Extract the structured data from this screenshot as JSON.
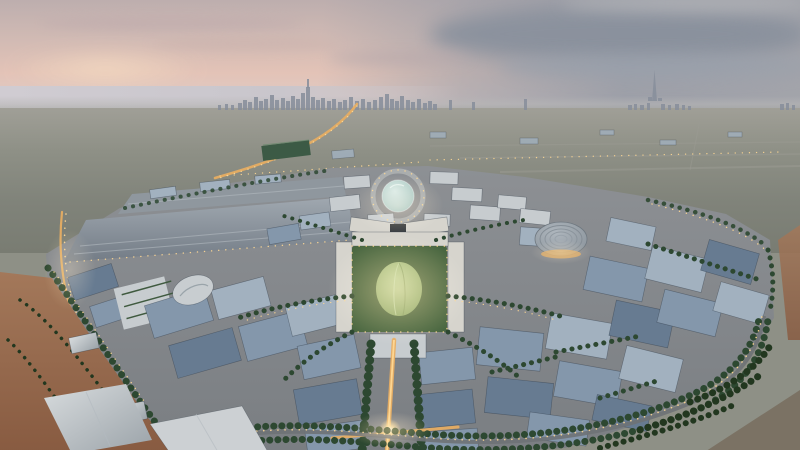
{
  "scene": {
    "description": "Aerial dusk rendering of a circular expo master-plan city (Expo 2020 Dubai style): illuminated boulevards, central garden dome, ribbed arena roof, long exhibition halls, palm-lined perimeter roads, desert sand, and the Dubai skyline with a tall spire tower on the horizon under a pink-and-grey sunset sky",
    "time_of_day": "dusk",
    "landmark_labels": {
      "skyline": "city skyline",
      "tall_tower": "tall spire tower",
      "glass_dome": "glass dome plaza",
      "green_dome": "garden dome pavilion",
      "arena": "ribbed round arena roof",
      "halls": "exhibition halls",
      "avenue": "illuminated avenue",
      "boulevard": "palm-lined boulevard",
      "desert": "desert sand"
    }
  },
  "colors": {
    "sky-top": "#bdaeae",
    "sky-warm": "#e3c3b7",
    "sky-glow": "#f2d8c0",
    "cloud-dark": "#8a919d",
    "cloud-mid": "#9aa1ac",
    "sea": "#c9c6cc",
    "skyline": "#878e9b",
    "plain-1": "#a09f97",
    "plain-2": "#8e9086",
    "plain-3": "#797c72",
    "site-1": "#8d9094",
    "site-2": "#7a7e82",
    "hall-1": "#a0a8b0",
    "hall-2": "#737c86",
    "roof-a": "#a2b1bf",
    "roof-b": "#8497ab",
    "roof-c": "#677b91",
    "roof-d": "#55697f",
    "white-1": "#c7cccf",
    "warm-white": "#d6d4cd",
    "trees": "#2d4831",
    "trees-dark": "#22371f",
    "garden": "#47653f",
    "dome-green-1": "#b7ca8c",
    "dome-green-2": "#87a263",
    "glass-1": "#d6e8e3",
    "glass-2": "#9cc0bb",
    "arena-1": "#aeb6bd",
    "arena-2": "#868f97",
    "sand-1": "#a3785a",
    "sand-2": "#885b41",
    "glow": "#e8ae62",
    "glow-bright": "#ffd894",
    "road": "#6e7276",
    "road-faint": "#9c9c94",
    "green-roof": "#3c5a45",
    "shed": "#c9ccd0"
  }
}
